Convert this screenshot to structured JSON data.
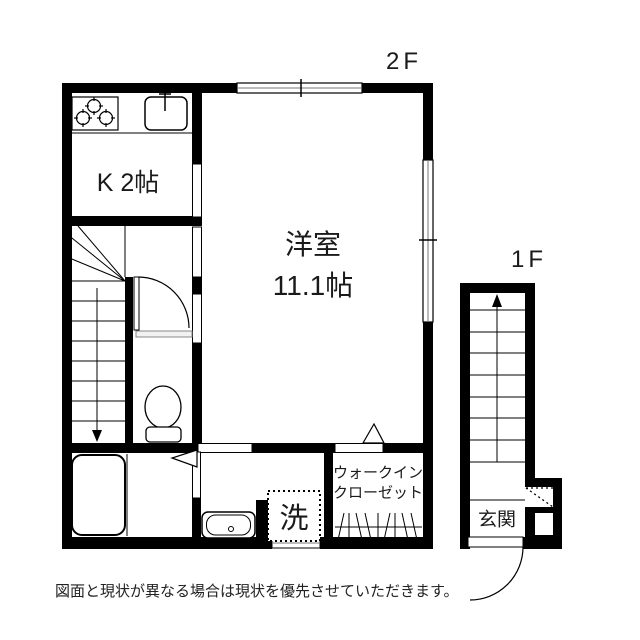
{
  "canvas": {
    "background": "#ffffff",
    "ink": "#000000"
  },
  "plan_2f": {
    "floor_label": "2F",
    "kitchen_label": "K 2帖",
    "main_room_name": "洋室",
    "main_room_size": "11.1帖",
    "wic_label_line1": "ウォークイン",
    "wic_label_line2": "クローゼット",
    "laundry_label": "洗"
  },
  "plan_1f": {
    "floor_label": "1F",
    "entrance_label": "玄関"
  },
  "disclaimer": "図面と現状が異なる場合は現状を優先させていただきます。"
}
